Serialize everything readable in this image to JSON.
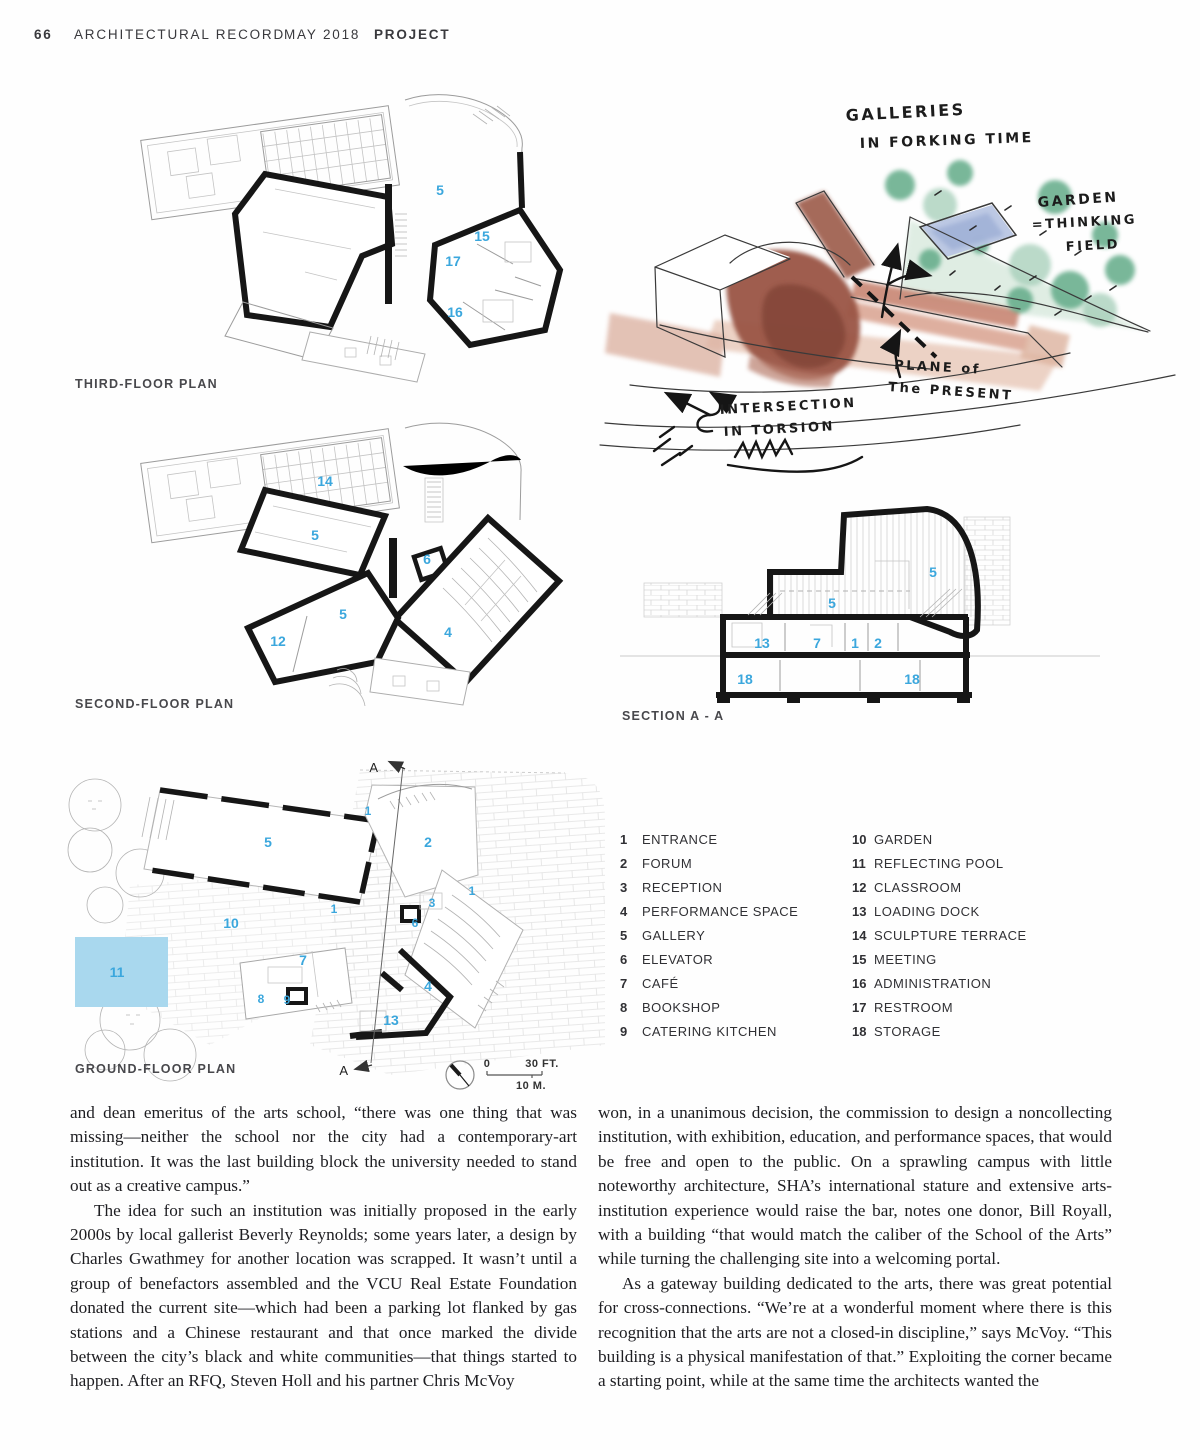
{
  "header": {
    "page_number": "66",
    "publication": "ARCHITECTURAL RECORD",
    "issue": "MAY 2018",
    "section": "PROJECT"
  },
  "colors": {
    "accent_blue": "#3ba7dd",
    "pool_blue": "#a9d8ee"
  },
  "plans": {
    "third": {
      "label": "THIRD-FLOOR PLAN",
      "numbers": [
        {
          "n": "5",
          "x": 365,
          "y": 103
        },
        {
          "n": "15",
          "x": 407,
          "y": 149
        },
        {
          "n": "17",
          "x": 378,
          "y": 174
        },
        {
          "n": "16",
          "x": 380,
          "y": 225
        }
      ]
    },
    "second": {
      "label": "SECOND-FLOOR PLAN",
      "numbers": [
        {
          "n": "14",
          "x": 250,
          "y": 66
        },
        {
          "n": "5",
          "x": 240,
          "y": 120
        },
        {
          "n": "6",
          "x": 352,
          "y": 144
        },
        {
          "n": "5",
          "x": 268,
          "y": 199
        },
        {
          "n": "12",
          "x": 203,
          "y": 226
        },
        {
          "n": "4",
          "x": 373,
          "y": 217
        }
      ]
    },
    "ground": {
      "label": "GROUND-FLOOR PLAN",
      "marker": "A",
      "numbers": [
        {
          "n": "1",
          "x": 308,
          "y": 70,
          "s": 12
        },
        {
          "n": "5",
          "x": 208,
          "y": 102
        },
        {
          "n": "2",
          "x": 368,
          "y": 102
        },
        {
          "n": "1",
          "x": 412,
          "y": 150,
          "s": 12
        },
        {
          "n": "10",
          "x": 171,
          "y": 183
        },
        {
          "n": "3",
          "x": 372,
          "y": 162,
          "s": 12
        },
        {
          "n": "6",
          "x": 355,
          "y": 182,
          "s": 12
        },
        {
          "n": "11",
          "x": 57,
          "y": 232
        },
        {
          "n": "7",
          "x": 243,
          "y": 220
        },
        {
          "n": "8",
          "x": 201,
          "y": 258,
          "s": 12
        },
        {
          "n": "9",
          "x": 227,
          "y": 259,
          "s": 12
        },
        {
          "n": "4",
          "x": 368,
          "y": 246
        },
        {
          "n": "13",
          "x": 331,
          "y": 280
        },
        {
          "n": "1",
          "x": 274,
          "y": 168,
          "s": 12
        }
      ]
    },
    "section": {
      "label": "SECTION A - A",
      "numbers": [
        {
          "n": "5",
          "x": 313,
          "y": 72
        },
        {
          "n": "5",
          "x": 212,
          "y": 103
        },
        {
          "n": "13",
          "x": 142,
          "y": 143
        },
        {
          "n": "7",
          "x": 197,
          "y": 143
        },
        {
          "n": "1",
          "x": 235,
          "y": 143
        },
        {
          "n": "2",
          "x": 258,
          "y": 143
        },
        {
          "n": "18",
          "x": 125,
          "y": 179
        },
        {
          "n": "18",
          "x": 292,
          "y": 179
        }
      ]
    }
  },
  "sketch": {
    "annotations": [
      {
        "t": "GALLERIES",
        "x": 246,
        "y": 36,
        "r": -3,
        "s": 16
      },
      {
        "t": "IN FORKING TIME",
        "x": 260,
        "y": 63,
        "r": -2,
        "s": 14
      },
      {
        "t": "GARDEN",
        "x": 438,
        "y": 122,
        "r": -4,
        "s": 14
      },
      {
        "t": "=THINKING",
        "x": 432,
        "y": 144,
        "r": -3,
        "s": 13
      },
      {
        "t": "FIELD",
        "x": 466,
        "y": 166,
        "r": -3,
        "s": 13
      },
      {
        "t": "PLANE of",
        "x": 294,
        "y": 284,
        "r": 3,
        "s": 13
      },
      {
        "t": "The PRESENT",
        "x": 288,
        "y": 306,
        "r": 4,
        "s": 13
      },
      {
        "t": "INTERSECTION",
        "x": 120,
        "y": 329,
        "r": -3,
        "s": 13
      },
      {
        "t": "IN TORSION",
        "x": 124,
        "y": 351,
        "r": -3,
        "s": 13
      }
    ]
  },
  "scalebar": {
    "zero": "0",
    "feet": "30 FT.",
    "meters": "10 M."
  },
  "legend": {
    "col1": [
      {
        "num": "1",
        "label": "ENTRANCE"
      },
      {
        "num": "2",
        "label": "FORUM"
      },
      {
        "num": "3",
        "label": "RECEPTION"
      },
      {
        "num": "4",
        "label": "PERFORMANCE SPACE"
      },
      {
        "num": "5",
        "label": "GALLERY"
      },
      {
        "num": "6",
        "label": "ELEVATOR"
      },
      {
        "num": "7",
        "label": "CAFÉ"
      },
      {
        "num": "8",
        "label": "BOOKSHOP"
      },
      {
        "num": "9",
        "label": "CATERING KITCHEN"
      }
    ],
    "col2": [
      {
        "num": "10",
        "label": "GARDEN"
      },
      {
        "num": "11",
        "label": "REFLECTING POOL"
      },
      {
        "num": "12",
        "label": "CLASSROOM"
      },
      {
        "num": "13",
        "label": "LOADING DOCK"
      },
      {
        "num": "14",
        "label": "SCULPTURE TERRACE"
      },
      {
        "num": "15",
        "label": "MEETING"
      },
      {
        "num": "16",
        "label": "ADMINISTRATION"
      },
      {
        "num": "17",
        "label": "RESTROOM"
      },
      {
        "num": "18",
        "label": "STORAGE"
      }
    ]
  },
  "article": {
    "left": [
      "and dean emeritus of the arts school, “there was one thing that was missing—neither the school nor the city had a contemporary-art institution. It was the last building block the university needed to stand out as a creative campus.”",
      "The idea for such an institution was initially proposed in the early 2000s by local gallerist Beverly Reynolds; some years later, a design by Charles Gwathmey for another location was scrapped. It wasn’t until a group of benefactors assembled and the VCU Real Estate Foundation donated the current site—which had been a parking lot flanked by gas stations and a Chinese restaurant and that once marked the divide between the city’s black and white communities—that things started to happen. After an RFQ, Steven Holl and his partner Chris McVoy"
    ],
    "right": [
      "won, in a unanimous decision, the commission to design a noncollecting institution, with exhibition, education, and performance spaces, that would be free and open to the public. On a sprawling campus with little noteworthy architecture, SHA’s international stature and extensive arts-institution experience would raise the bar, notes one donor, Bill Royall, with a building “that would match the caliber of the School of the Arts” while turning the challenging site into a welcoming portal.",
      "As a gateway building dedicated to the arts, there was great potential for cross-connections. “We’re at a wonderful moment where there is this recognition that the arts are not a closed-in discipline,” says McVoy. “This building is a physical manifestation of that.” Exploiting the corner became a starting point, while at the same time the architects wanted the"
    ]
  }
}
